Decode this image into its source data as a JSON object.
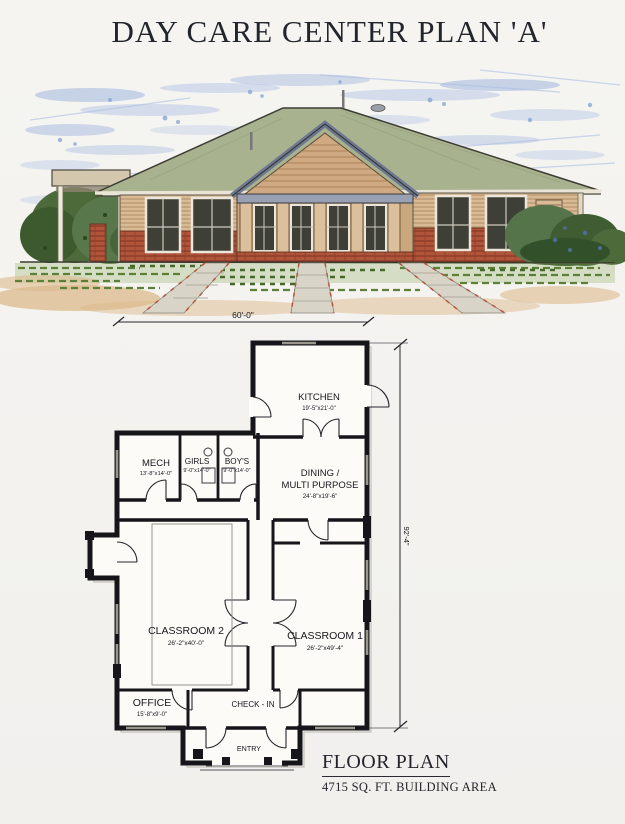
{
  "page": {
    "title": "DAY CARE CENTER PLAN 'A'"
  },
  "elevation": {
    "description": "front-elevation-watercolor-rendering",
    "width_dimension": "60'-0\""
  },
  "floor_plan": {
    "height_dimension": "92'-4\"",
    "rooms": {
      "kitchen": {
        "label": "KITCHEN",
        "dims": "19'-5\"x21'-0\""
      },
      "mech": {
        "label": "MECH",
        "dims": "13'-8\"x14'-0\""
      },
      "girls": {
        "label": "GIRLS",
        "dims": "9'-0\"x14'-0\""
      },
      "boys": {
        "label": "BOY'S",
        "dims": "9'-0\"x14'-0\""
      },
      "dining": {
        "label_line1": "DINING /",
        "label_line2": "MULTI PURPOSE",
        "dims": "24'-8\"x19'-6\""
      },
      "classroom2": {
        "label": "CLASSROOM 2",
        "dims": "26'-2\"x40'-0\""
      },
      "classroom1": {
        "label": "CLASSROOM 1",
        "dims": "26'-2\"x49'-4\""
      },
      "office": {
        "label": "OFFICE",
        "dims": "15'-8\"x9'-0\""
      },
      "checkin": {
        "label": "CHECK - IN"
      },
      "entry": {
        "label": "ENTRY"
      }
    },
    "caption": {
      "title": "FLOOR PLAN",
      "subtitle": "4715 SQ. FT. BUILDING AREA"
    }
  },
  "colors": {
    "roof": "#a9b28f",
    "siding": "#d9ba95",
    "brick": "#b0543a",
    "sky": "#8aa6d9",
    "grass": "#6d9248",
    "walkway": "#d8d4c8",
    "ink": "#15151a"
  }
}
